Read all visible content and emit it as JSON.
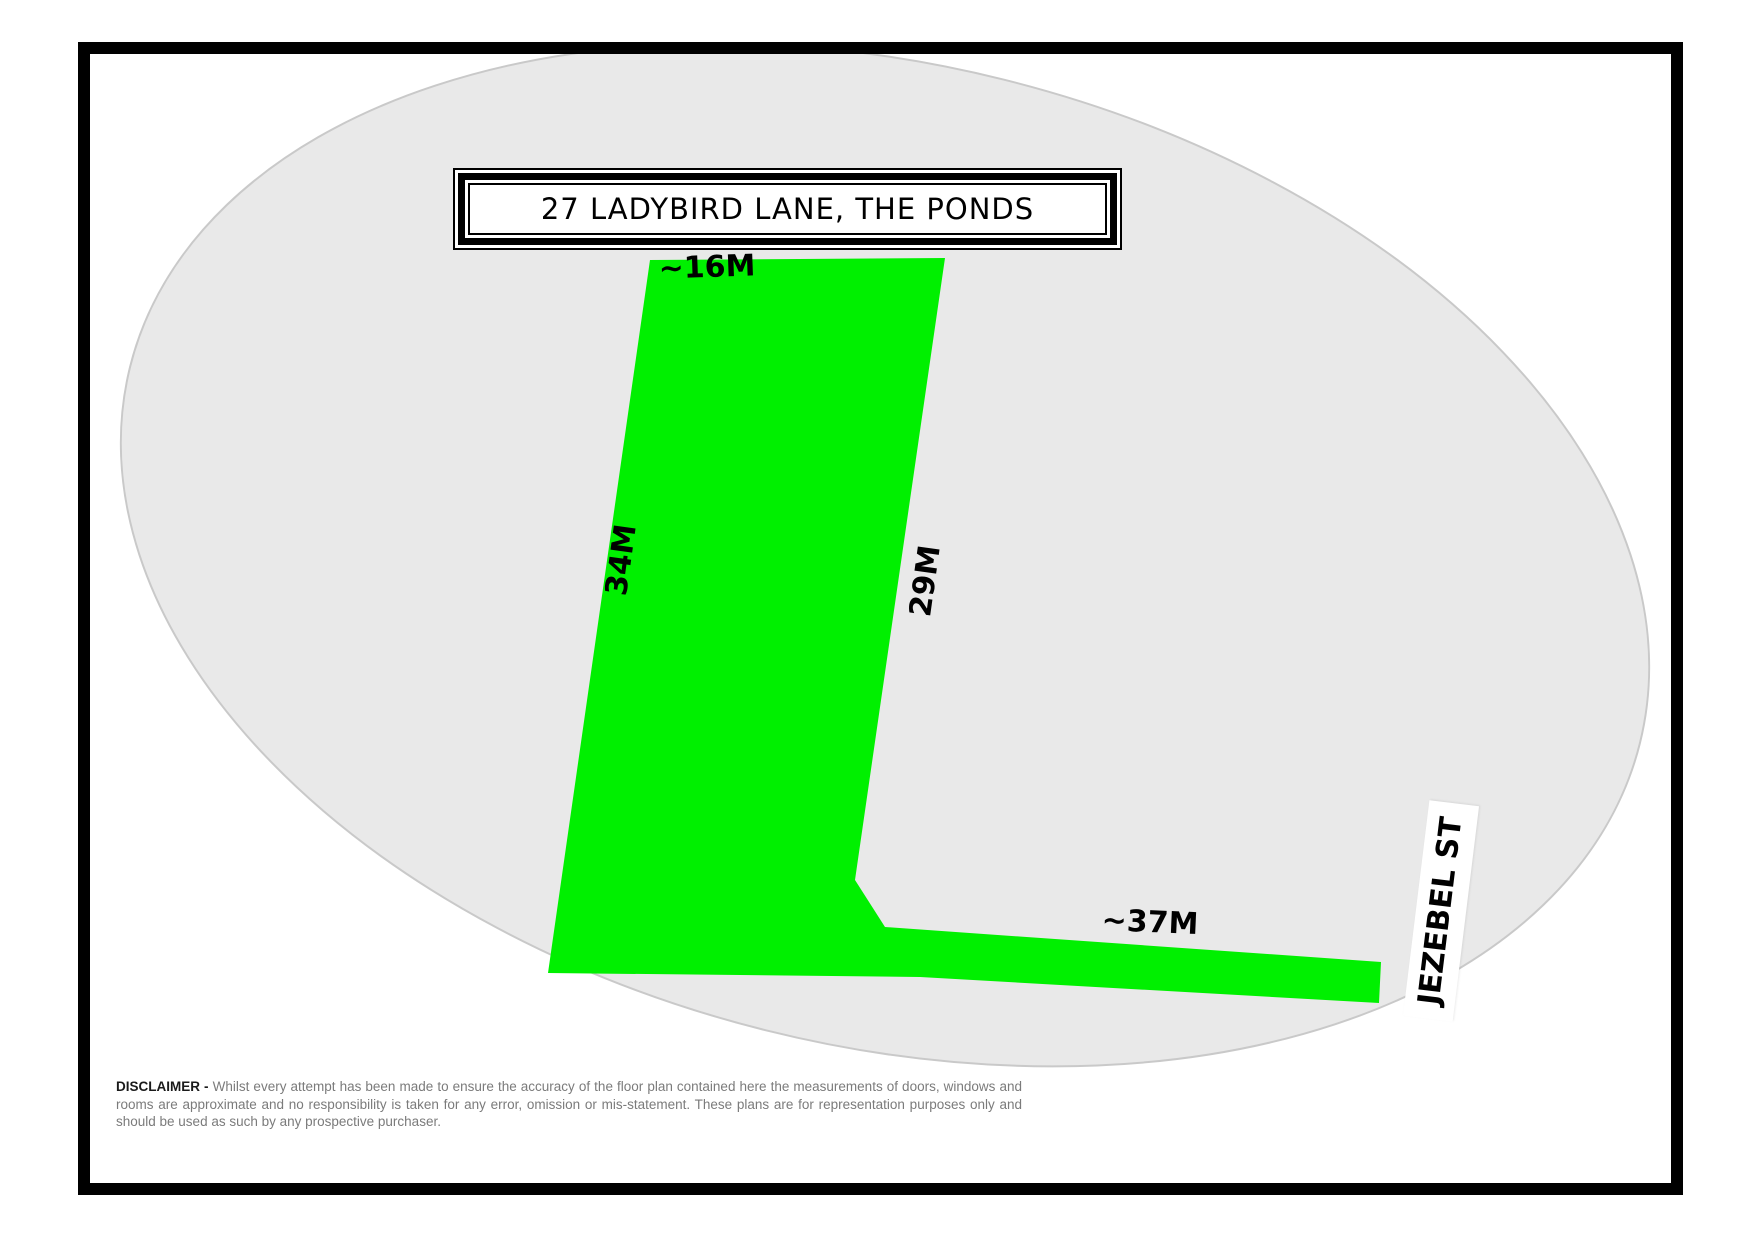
{
  "title": "27 LADYBIRD LANE, THE PONDS",
  "lot": {
    "top_measurement": "~16M",
    "left_measurement": "34M",
    "right_measurement": "29M",
    "bottom_measurement": "~37M"
  },
  "street_label": "JEZEBEL ST",
  "disclaimer": {
    "heading": "DISCLAIMER -",
    "body": "Whilst every attempt has been made to ensure the accuracy of the floor plan contained here the measurements of doors, windows and rooms are approximate and no responsibility is taken for any error, omission or mis-statement. These plans are for representation purposes only and should be used as such by any prospective purchaser."
  },
  "colors": {
    "lot_fill": "#00f000",
    "ellipse_fill": "#e9e9e9",
    "ellipse_edge": "#c9c9c9",
    "frame": "#000000",
    "disclaimer_text": "#7b7b7b"
  }
}
